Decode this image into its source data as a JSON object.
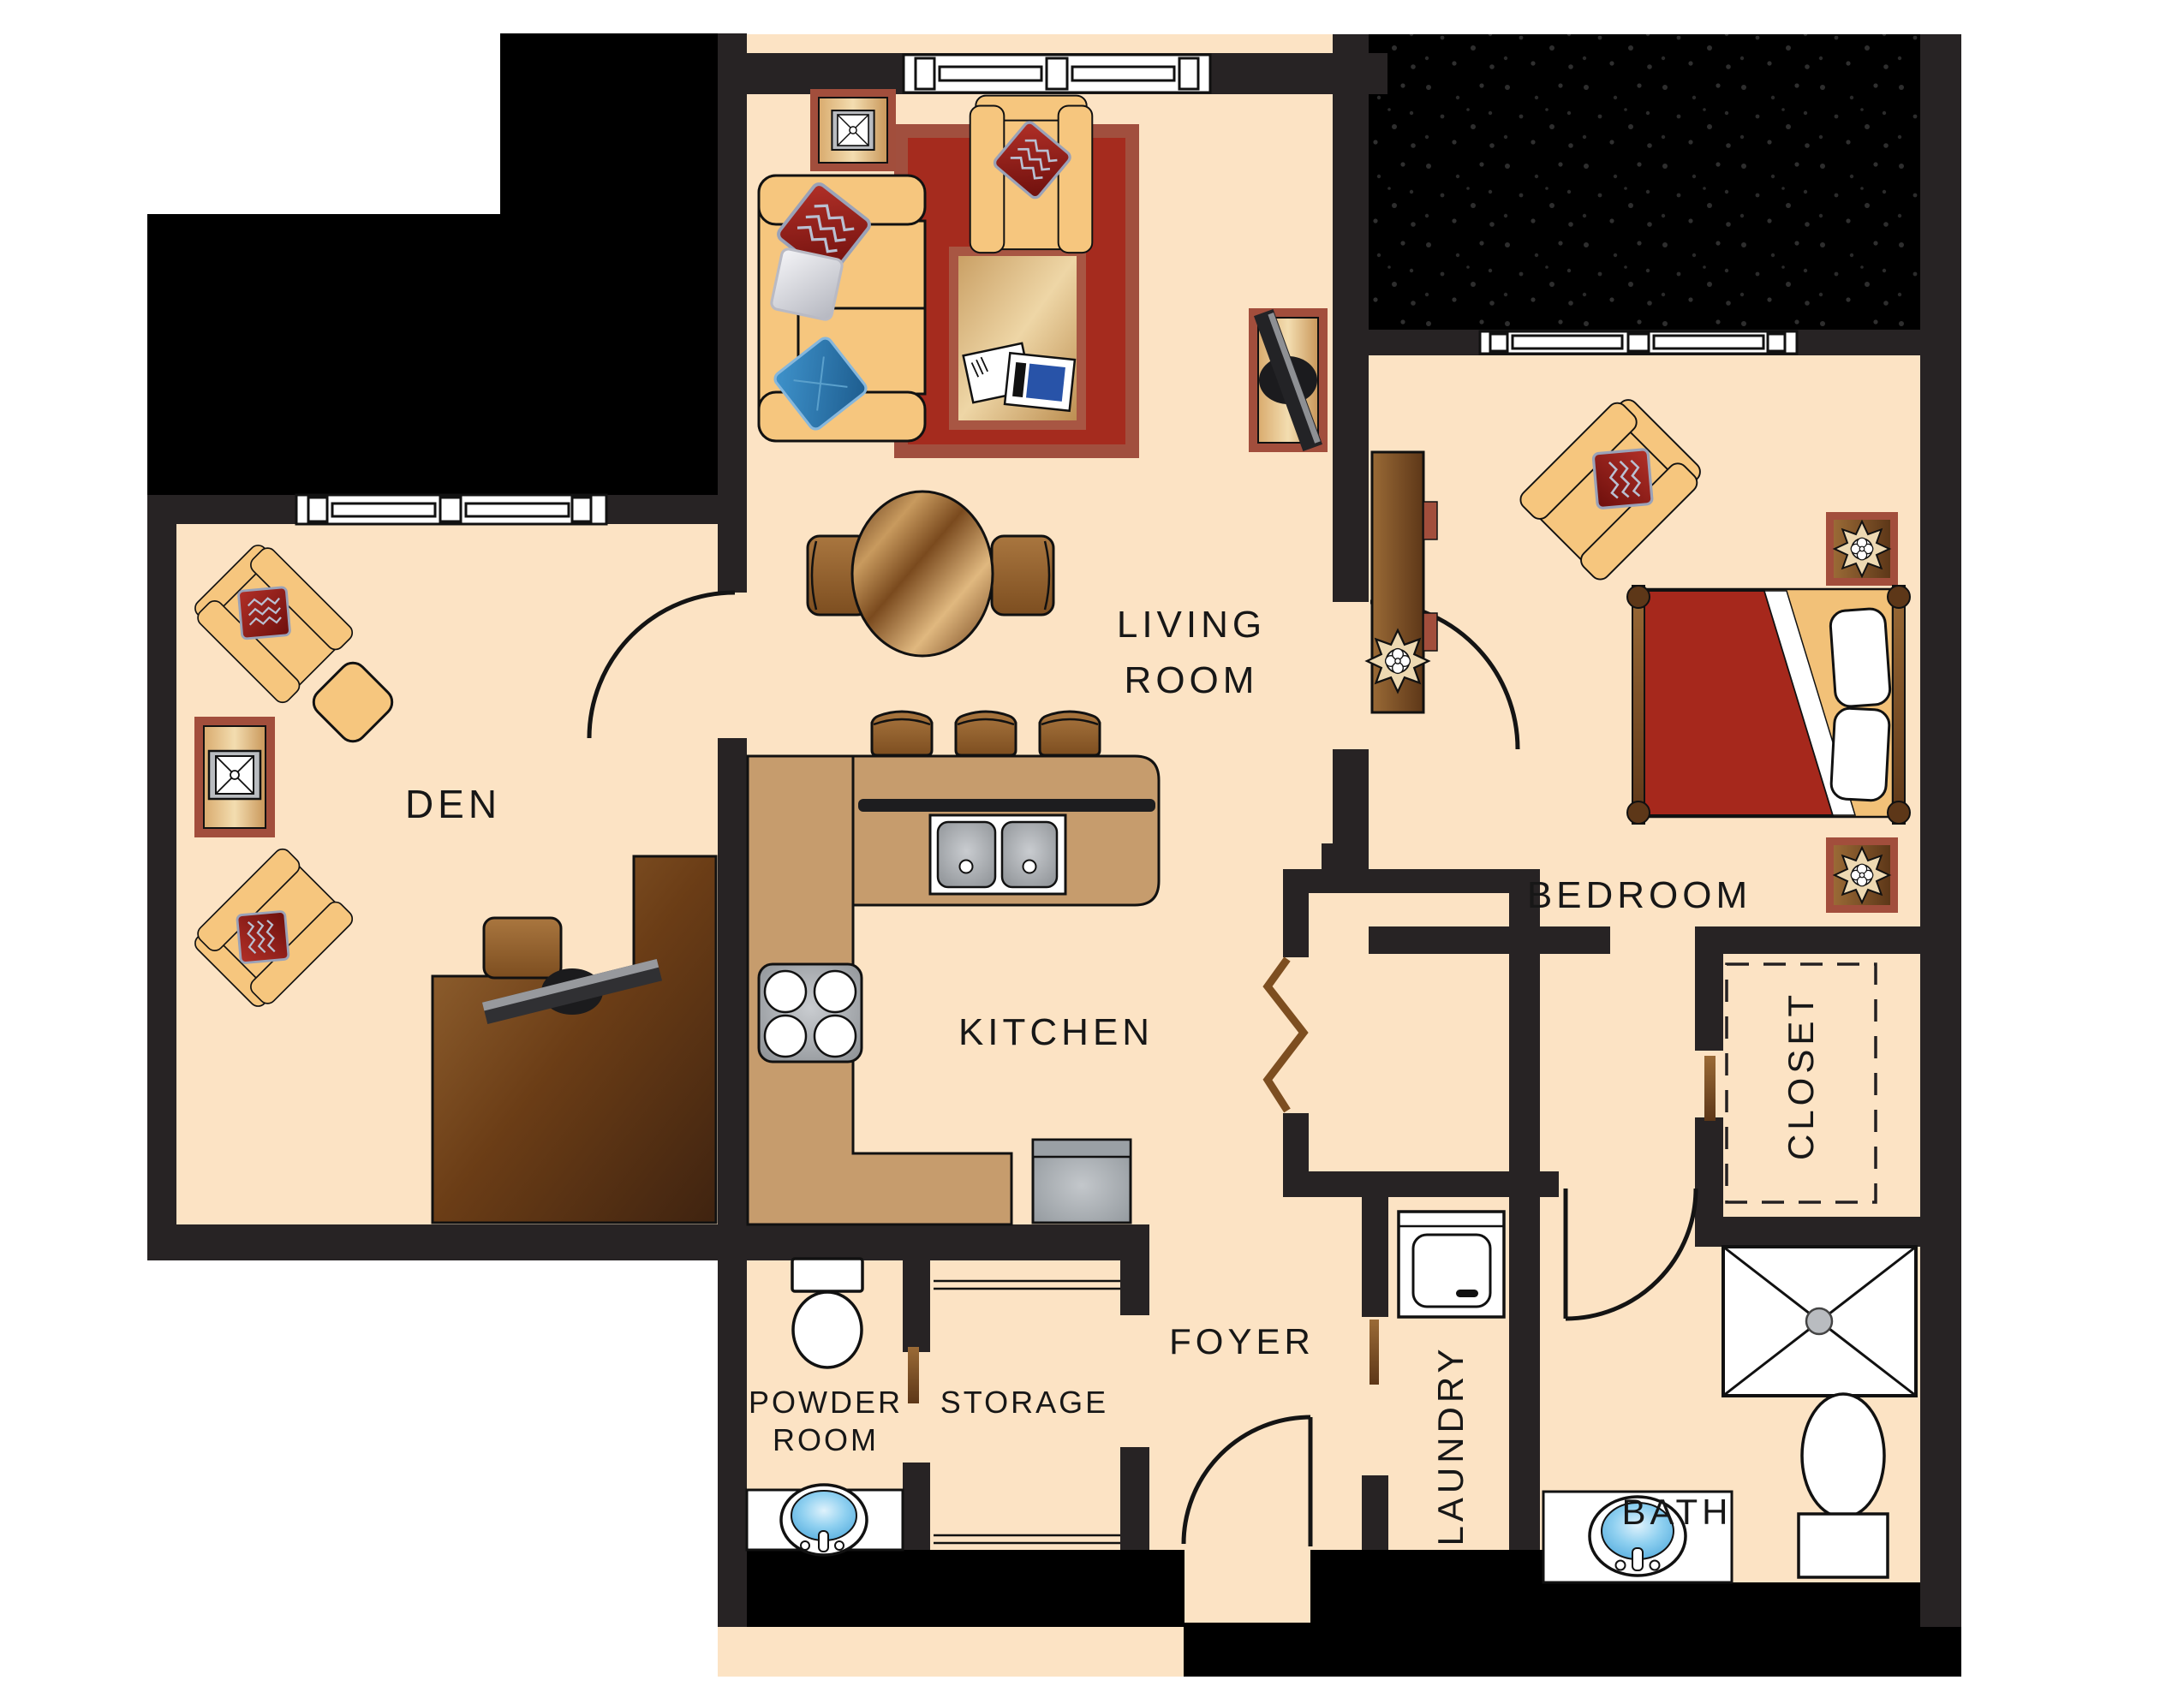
{
  "rooms": {
    "den": {
      "label": "DEN"
    },
    "living_room": {
      "label_line1": "LIVING",
      "label_line2": "ROOM"
    },
    "bedroom": {
      "label": "BEDROOM"
    },
    "kitchen": {
      "label": "KITCHEN"
    },
    "foyer": {
      "label": "FOYER"
    },
    "powder_room": {
      "label_line1": "POWDER",
      "label_line2": "ROOM"
    },
    "storage": {
      "label": "STORAGE"
    },
    "laundry": {
      "label": "LAUNDRY"
    },
    "bath": {
      "label": "BATH"
    },
    "closet": {
      "label": "CLOSET"
    }
  },
  "colors": {
    "floor": "#fce3c4",
    "wall": "#272324",
    "exterior_black": "#000000",
    "counter_wood": "#c69c6d",
    "rug_red": "#a52b1e",
    "rug_border": "#a14f3e",
    "upholstery_tan": "#f6c67e",
    "pillow_red": "#a32019",
    "pillow_blue": "#2d7fb8",
    "bed_cover_red": "#a6281c",
    "wood_dark": "#6b3d16",
    "wood_light": "#e2bd85",
    "accent_brick": "#a24e3c",
    "appliance_gray": "#a9adb2",
    "sink_blue": "#7cc4e8",
    "label_text": "#171717"
  },
  "furniture": {
    "den": [
      "armchair",
      "armchair",
      "ottoman",
      "tv-console",
      "desk",
      "desk-chair",
      "desk-monitor",
      "window"
    ],
    "living_room": [
      "sofa",
      "armchair",
      "area-rug",
      "coffee-table",
      "magazines",
      "media-console",
      "tv-console",
      "dining-table",
      "dining-chair",
      "dining-chair",
      "window"
    ],
    "kitchen": [
      "l-counter",
      "island",
      "bar-stool",
      "bar-stool",
      "bar-stool",
      "double-sink",
      "stove",
      "dishwasher"
    ],
    "bedroom": [
      "bed",
      "pillows",
      "dresser",
      "plant",
      "armchair",
      "nightstand",
      "nightstand",
      "plant",
      "plant",
      "window"
    ],
    "bath": [
      "shower",
      "toilet",
      "vanity-sink"
    ],
    "powder_room": [
      "toilet",
      "vanity-sink"
    ],
    "laundry": [
      "washer"
    ],
    "closet": [
      "shelf-dashed-outline"
    ],
    "foyer": [
      "entry-door",
      "bifold-closet-door"
    ],
    "storage": [
      "shelves"
    ]
  }
}
